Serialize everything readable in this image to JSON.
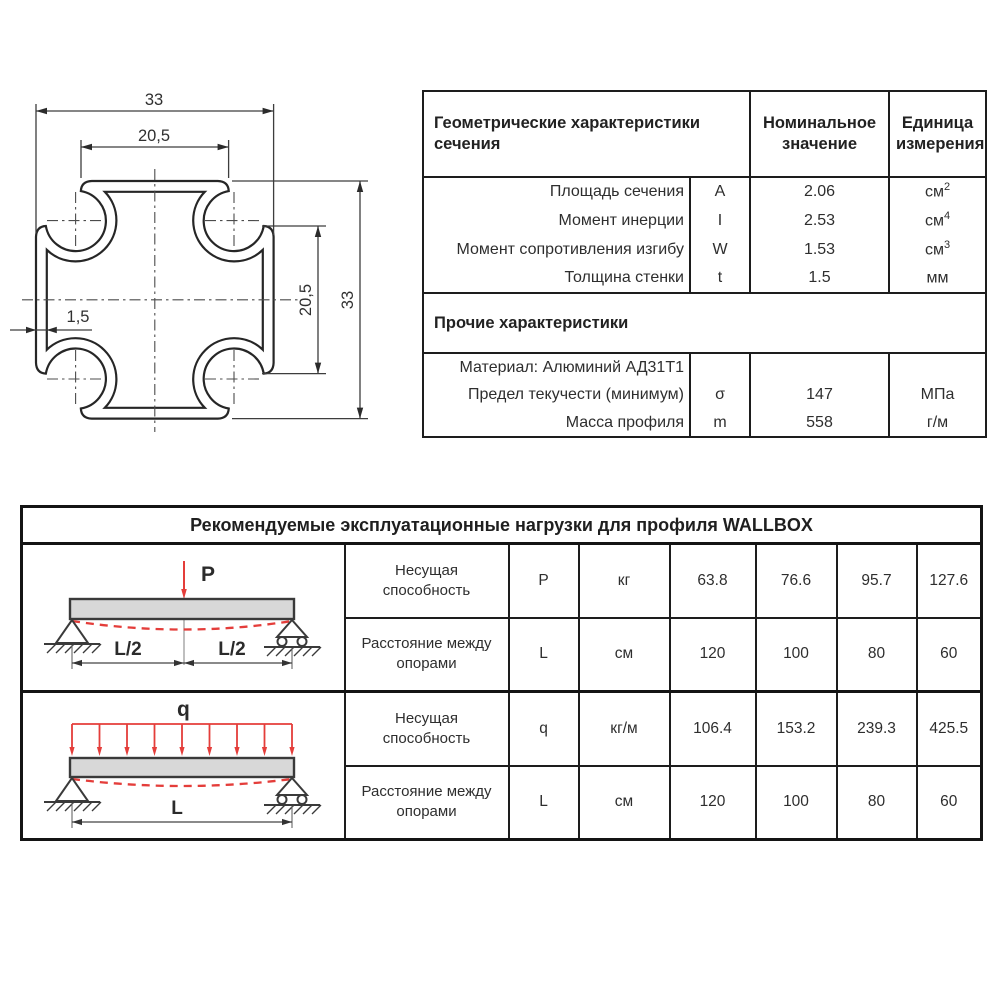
{
  "drawing": {
    "dim_total_width": "33",
    "dim_inner_width": "20,5",
    "dim_wall": "1,5",
    "dim_inner_height": "20,5",
    "dim_total_height": "33"
  },
  "geometry_table": {
    "title": "Геометрические характеристики сечения",
    "col_value": "Номинальное значение",
    "col_unit": "Единица измерения",
    "rows": [
      {
        "label": "Площадь сечения",
        "symbol": "A",
        "value": "2.06",
        "unit": "см",
        "unit_sup": "2"
      },
      {
        "label": "Момент инерции",
        "symbol": "I",
        "value": "2.53",
        "unit": "см",
        "unit_sup": "4"
      },
      {
        "label": "Момент сопротивления изгибу",
        "symbol": "W",
        "value": "1.53",
        "unit": "см",
        "unit_sup": "3"
      },
      {
        "label": "Толщина стенки",
        "symbol": "t",
        "value": "1.5",
        "unit": "мм",
        "unit_sup": ""
      }
    ],
    "section_other": "Прочие характеристики",
    "other_rows": [
      {
        "label": "Материал: Алюминий АД31Т1",
        "symbol": "",
        "value": "",
        "unit": "",
        "unit_sup": ""
      },
      {
        "label": "Предел текучести (минимум)",
        "symbol": "σ",
        "value": "147",
        "unit": "МПа",
        "unit_sup": ""
      },
      {
        "label": "Масса профиля",
        "symbol": "m",
        "value": "558",
        "unit": "г/м",
        "unit_sup": ""
      }
    ]
  },
  "loads_table": {
    "title": "Рекомендуемые эксплуатационные нагрузки для профиля WALLBOX",
    "rows": [
      {
        "label": "Несущая способность",
        "symbol": "P",
        "unit": "кг",
        "values": [
          "63.8",
          "76.6",
          "95.7",
          "127.6"
        ]
      },
      {
        "label": "Расстояние между опорами",
        "symbol": "L",
        "unit": "см",
        "values": [
          "120",
          "100",
          "80",
          "60"
        ]
      },
      {
        "label": "Несущая способность",
        "symbol": "q",
        "unit": "кг/м",
        "values": [
          "106.4",
          "153.2",
          "239.3",
          "425.5"
        ]
      },
      {
        "label": "Расстояние между опорами",
        "symbol": "L",
        "unit": "см",
        "values": [
          "120",
          "100",
          "80",
          "60"
        ]
      }
    ],
    "diagram1": {
      "load_label": "P",
      "span_left": "L/2",
      "span_right": "L/2"
    },
    "diagram2": {
      "load_label": "q",
      "span": "L"
    }
  },
  "colors": {
    "accent_red": "#e43d3a",
    "line_dark": "#2a2a2a"
  }
}
